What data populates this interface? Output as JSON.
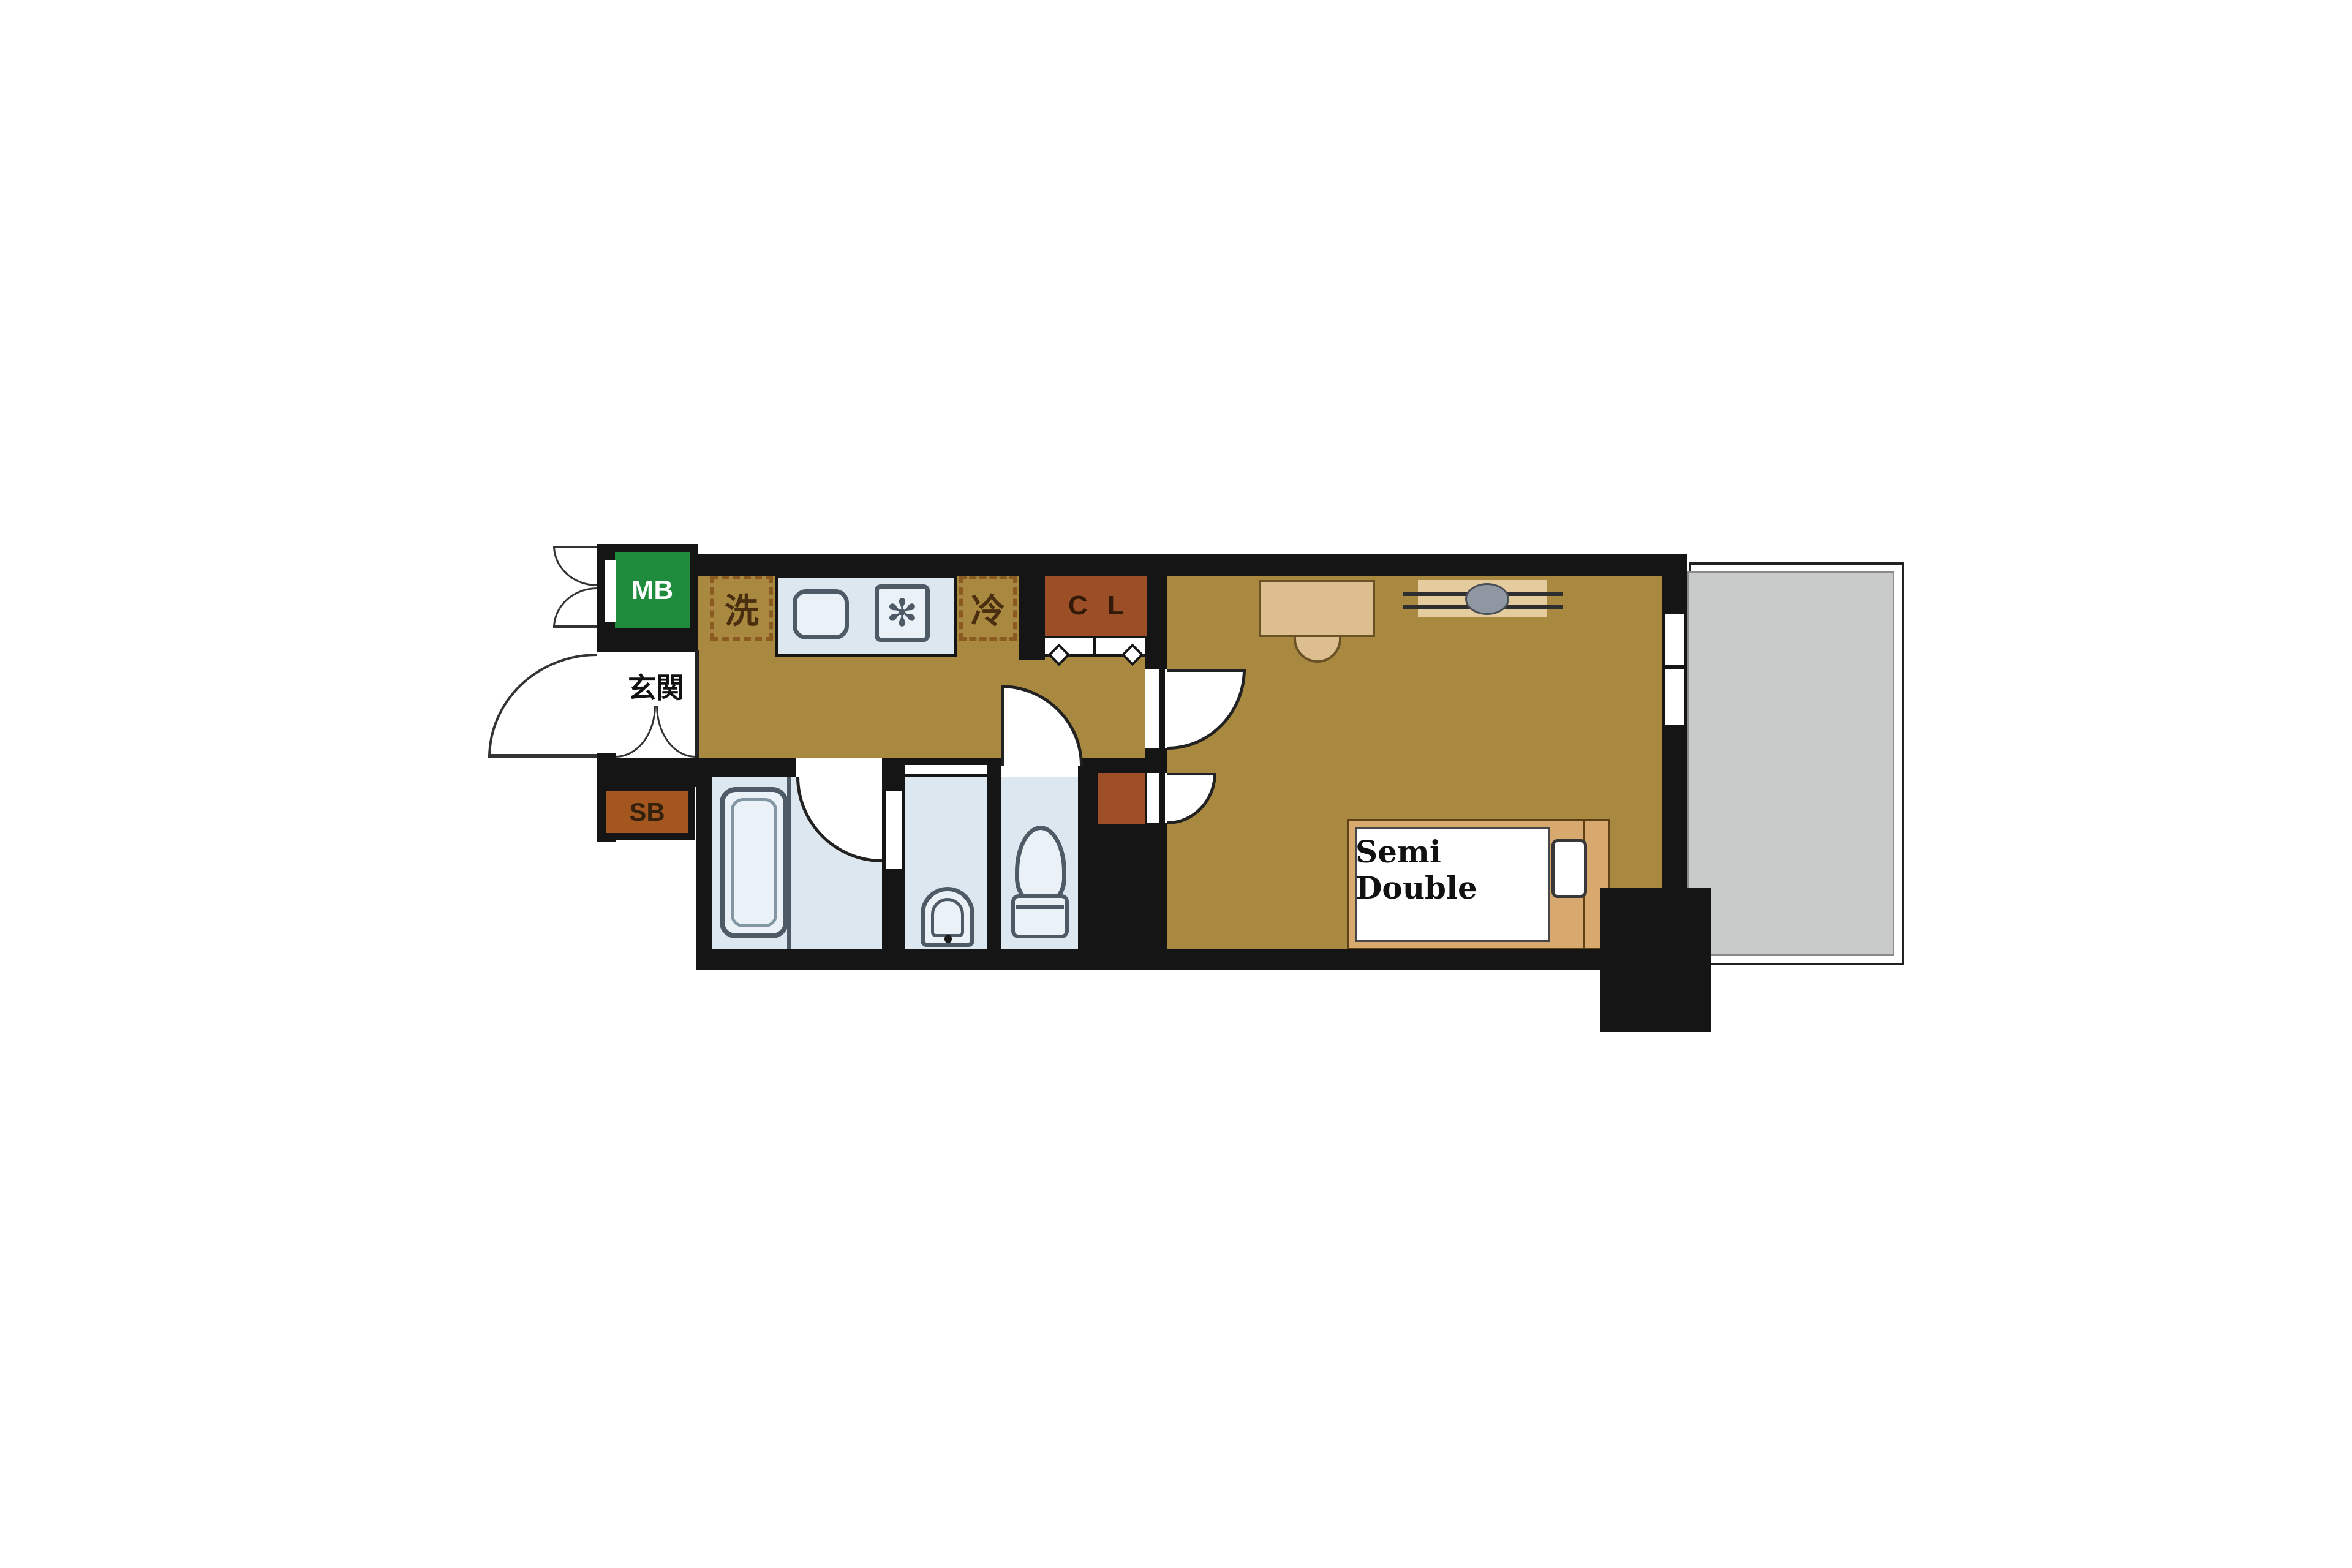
{
  "floorplan": {
    "labels": {
      "meter_box": "MB",
      "entrance": "玄関",
      "shoe_box": "SB",
      "washer": "洗",
      "refrigerator": "冷",
      "closet": "C L",
      "bed": "Semi Double"
    },
    "icons": {
      "stove_burner": "✻"
    },
    "colors": {
      "wall": "#151515",
      "floor": "#A9883F",
      "wet": "#DCE7F0",
      "stroke": "#4E5B66",
      "fixfill": "#EAF2F8",
      "closet": "#9C4F26",
      "ps": "#9E4F28",
      "shoebox": "#A3571F",
      "mb": "#1E8C3C",
      "balcony": "#C9CBCB",
      "balconyline": "#8A8A8A",
      "bedframe": "#D8A96E",
      "furn": "#DCBE8F",
      "acgray": "#8F97A3",
      "dash": "#8A5A20",
      "labeldark": "#4A2E10",
      "ink": "#111111"
    }
  }
}
